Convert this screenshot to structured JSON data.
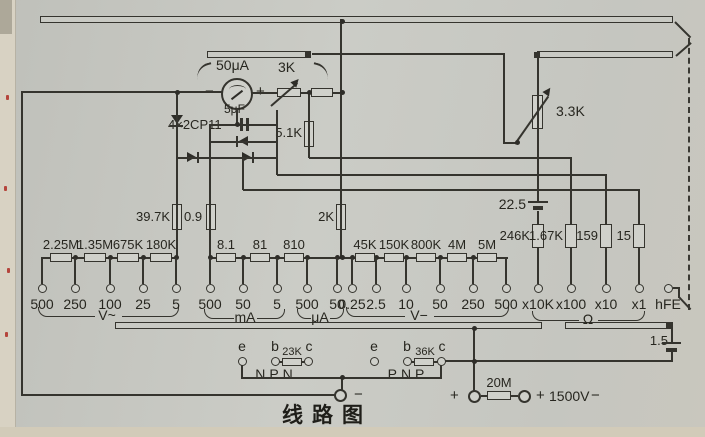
{
  "title": "线路图",
  "meter": {
    "range": "50μA",
    "minus": "−",
    "plus": "+",
    "pot": "3K"
  },
  "rectifier": {
    "label": "4×2CP11",
    "cap": "5μF"
  },
  "top_resistors": {
    "r51k": "5.1K",
    "r397k": "39.7K",
    "r09": "0.9",
    "r2k": "2K",
    "pot33k": "3.3K"
  },
  "battery_hv": {
    "value": "22.5"
  },
  "battery_lv": {
    "value": "1.5"
  },
  "sections": {
    "vac": {
      "label": "V~",
      "resistors": [
        "2.25M",
        "1.35M",
        "675K",
        "180K"
      ],
      "terminals": [
        "500",
        "250",
        "100",
        "25",
        "5"
      ]
    },
    "ma": {
      "label": "mA",
      "resistors": [
        "8.1",
        "81",
        "810"
      ],
      "terminals": [
        "500",
        "50",
        "5"
      ]
    },
    "ua": {
      "label": "μA",
      "terminals": [
        "500",
        "50"
      ]
    },
    "vdc": {
      "label": "V−",
      "resistors": [
        "45K",
        "150K",
        "800K",
        "4M",
        "5M"
      ],
      "terminals": [
        "0.25",
        "2.5",
        "10",
        "50",
        "250",
        "500"
      ]
    },
    "ohm": {
      "label": "Ω",
      "resistors": [
        "246K",
        "1.67K",
        "159",
        "15"
      ],
      "terminals": [
        "x10K",
        "x100",
        "x10",
        "x1"
      ]
    },
    "hfe": {
      "terminal": "hFE"
    }
  },
  "transistor_test": {
    "npn": {
      "label": "NPN",
      "e": "e",
      "b": "b",
      "c": "c",
      "resistor": "23K"
    },
    "pnp": {
      "label": "PNP",
      "e": "e",
      "b": "b",
      "c": "c",
      "resistor": "36K"
    }
  },
  "high_voltage": {
    "plus_left": "+",
    "resistor": "20M",
    "plus_right": "+",
    "label": "1500V",
    "minus": "−"
  },
  "common_terminal": {
    "minus": "−"
  },
  "ink_color": "#35342e",
  "paper_color": "#c7c8c2"
}
